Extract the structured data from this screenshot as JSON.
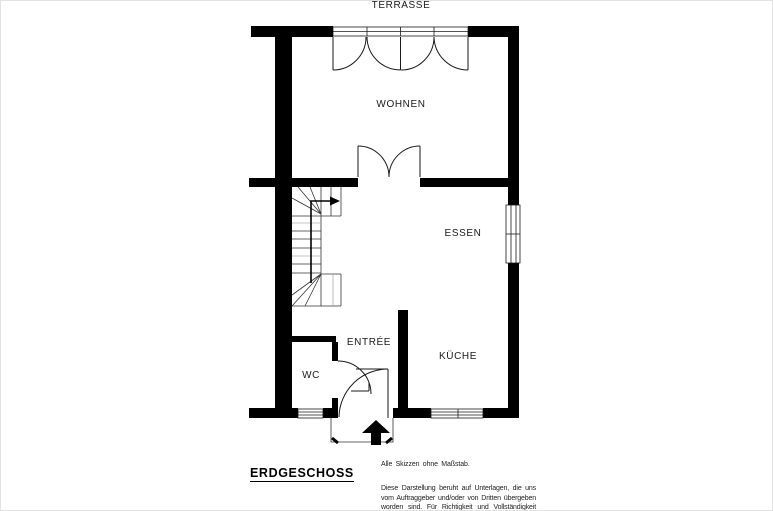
{
  "page": {
    "background": "#ffffff",
    "wall_color": "#000000",
    "line_color": "#1a1a1a"
  },
  "rooms": {
    "terrasse": "TERRASSE",
    "wohnen": "WOHNEN",
    "essen": "ESSEN",
    "entree": "ENTRÉE",
    "wc": "WC",
    "kueche": "KÜCHE"
  },
  "floor": {
    "label": "ERDGESCHOSS"
  },
  "notes": {
    "scale": "Alle Skizzen ohne Maßstab.",
    "disclaimer": "Diese Darstellung beruht auf Unterlagen, die uns vom Auftraggeber und/oder von Dritten übergeben worden sind. Für Richtigkeit und Vollständigkeit können wir daher keine Gewähr übernehmen."
  }
}
